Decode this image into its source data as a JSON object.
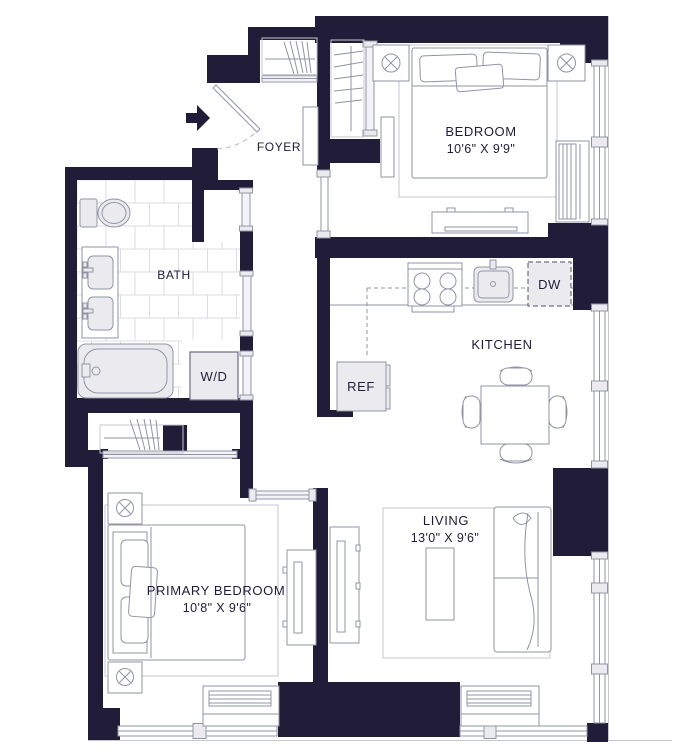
{
  "plan": {
    "title": "One-bedroom apartment floor plan",
    "rooms": {
      "foyer": {
        "label": "FOYER"
      },
      "bedroom": {
        "label": "BEDROOM",
        "dims": "10'6\" X 9'9\""
      },
      "bath": {
        "label": "BATH"
      },
      "kitchen": {
        "label": "KITCHEN"
      },
      "living": {
        "label": "LIVING",
        "dims": "13'0\" X 9'6\""
      },
      "primary_bedroom": {
        "label": "PRIMARY BEDROOM",
        "dims": "10'8\" X 9'6\""
      }
    },
    "fixtures": {
      "washer_dryer": "W/D",
      "refrigerator": "REF",
      "dishwasher": "DW"
    },
    "colors": {
      "wall": "#211d38",
      "outline": "#9294a6",
      "light_fill": "#ebebef",
      "tile_line": "#dcdce4",
      "rug_line": "#c6c6d1",
      "text": "#211d38",
      "background": "#ffffff"
    }
  }
}
